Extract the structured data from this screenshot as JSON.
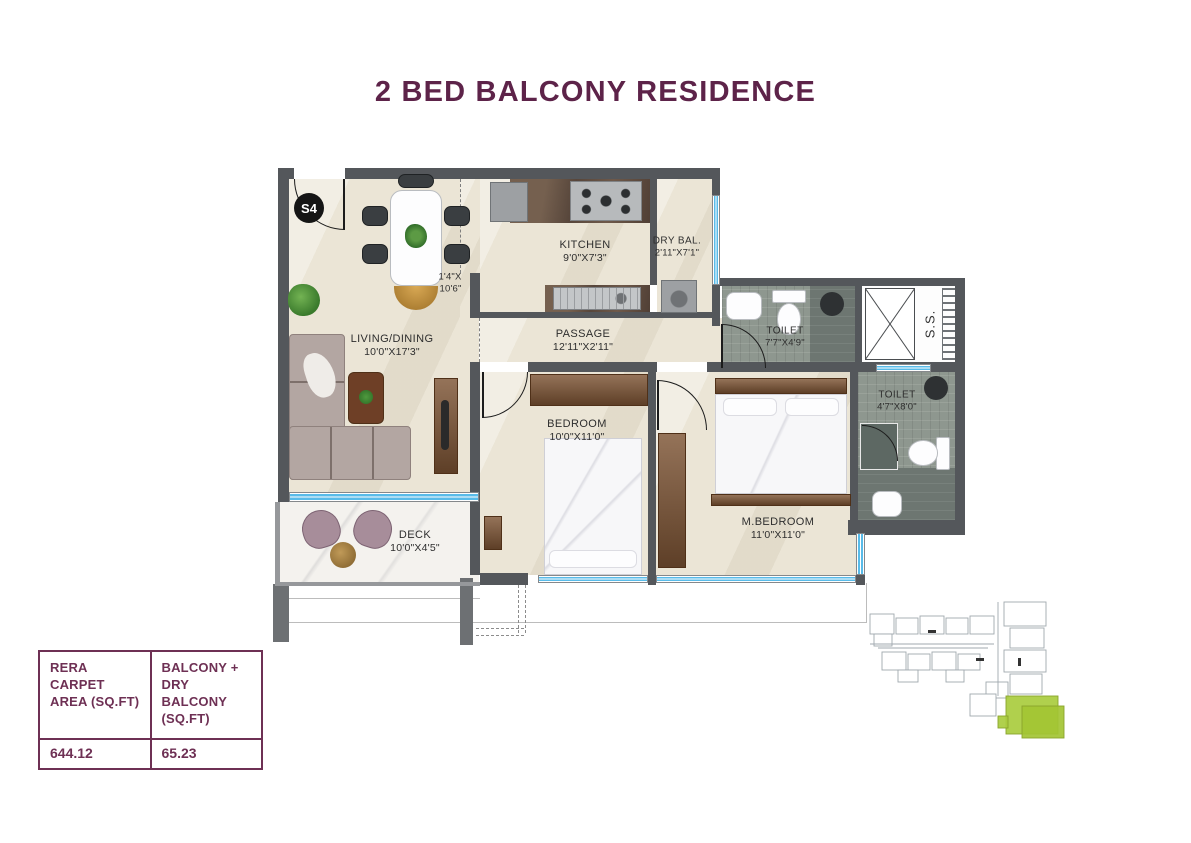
{
  "title": "2 BED BALCONY RESIDENCE",
  "unit": {
    "badge": "S4"
  },
  "rooms": {
    "living": {
      "name": "LIVING/DINING",
      "dims": "10'0\"X17'3\""
    },
    "kitchen": {
      "name": "KITCHEN",
      "dims": "9'0\"X7'3\""
    },
    "dry_balcony": {
      "name": "DRY BAL.",
      "dims": "2'11\"X7'1\""
    },
    "passage": {
      "name": "PASSAGE",
      "dims": "12'11\"X2'11\""
    },
    "toilet_common": {
      "name": "TOILET",
      "dims": "7'7\"X4'9\""
    },
    "toilet_master": {
      "name": "TOILET",
      "dims": "4'7\"X8'0\""
    },
    "bedroom": {
      "name": "BEDROOM",
      "dims": "10'0\"X11'0\""
    },
    "master_bedroom": {
      "name": "M.BEDROOM",
      "dims": "11'0\"X11'0\""
    },
    "deck": {
      "name": "DECK",
      "dims": "10'0\"X4'5\""
    },
    "foyer": {
      "dims_line1": "1'4\"X",
      "dims_line2": "10'6\""
    },
    "service_shaft": {
      "name": "S.S."
    }
  },
  "area_table": {
    "col1": {
      "header": "RERA CARPET\nAREA (SQ.FT)",
      "value": "644.12"
    },
    "col2": {
      "header": "BALCONY +\nDRY BALCONY\n(SQ.FT)",
      "value": "65.23"
    }
  },
  "colors": {
    "accent_maroon": "#5d2349",
    "table_maroon": "#6e3054",
    "window_blue": "#58bbe9",
    "keyplan_highlight_green": "#a9cc3e",
    "wall_gray": "#54575b"
  }
}
